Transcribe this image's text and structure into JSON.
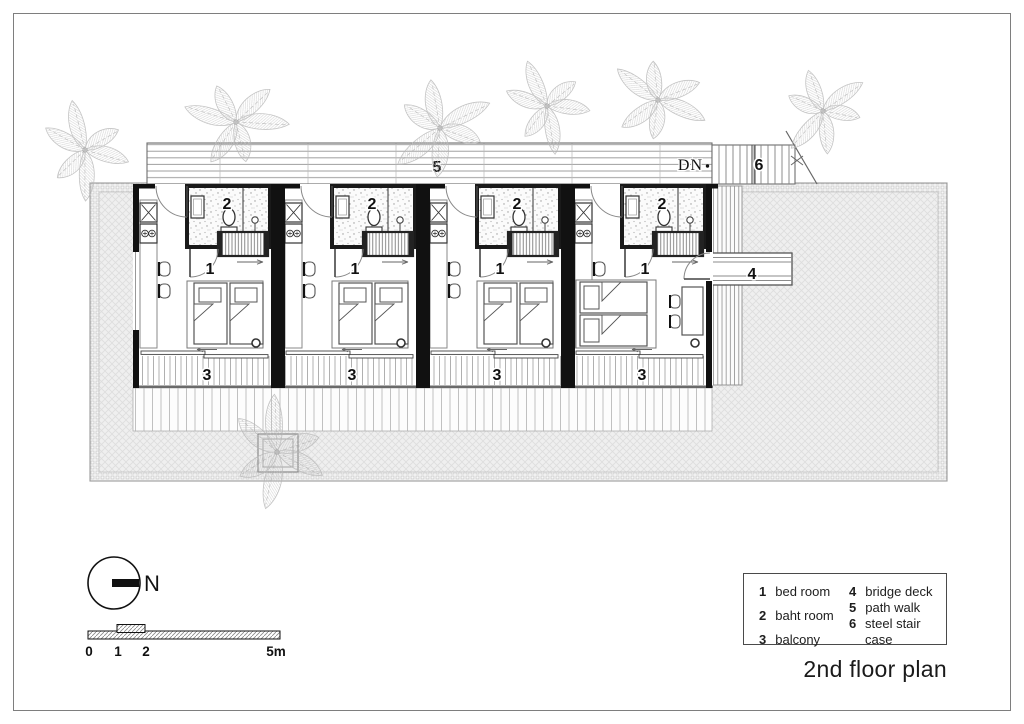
{
  "title": "2nd floor plan",
  "plan": {
    "dn_label": "DN",
    "units_count": 4,
    "labels": {
      "bedroom": "1",
      "bathroom": "2",
      "balcony": "3",
      "bridge_deck": "4",
      "path_walk": "5",
      "stair_case": "6"
    }
  },
  "legend": {
    "items": [
      {
        "num": "1",
        "label": "bed room"
      },
      {
        "num": "2",
        "label": "baht room"
      },
      {
        "num": "3",
        "label": "balcony"
      },
      {
        "num": "4",
        "label": "bridge deck"
      },
      {
        "num": "5",
        "label": "path walk"
      },
      {
        "num": "6",
        "label": "steel stair case"
      }
    ]
  },
  "north": {
    "label": "N"
  },
  "scale_bar": {
    "ticks": [
      "0",
      "1",
      "2",
      "5m"
    ]
  },
  "colors": {
    "ink": "#1a1a1a",
    "wall": "#111111",
    "deck_fill": "#efefef",
    "hatch_line": "#dcdcdc",
    "tree": "#b8b8b8"
  }
}
